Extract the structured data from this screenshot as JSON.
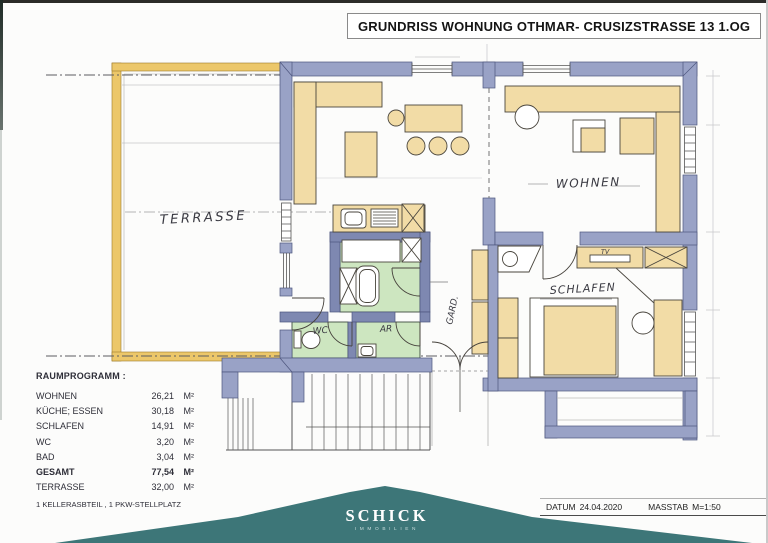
{
  "title": "GRUNDRISS WOHNUNG OTHMAR- CRUSIZSTRASSE 13  1.OG",
  "rooms": {
    "terrasse": "TERRASSE",
    "wohnen": "WOHNEN",
    "schlafen": "SCHLAFEN",
    "wc": "WC",
    "ar": "AR",
    "gard": "GARD.",
    "tv_label": "TV"
  },
  "raumprogramm": {
    "heading": "RAUMPROGRAMM :",
    "rows": [
      {
        "label": "WOHNEN",
        "value": "26,21",
        "unit": "M²"
      },
      {
        "label": "KÜCHE; ESSEN",
        "value": "30,18",
        "unit": "M²"
      },
      {
        "label": "SCHLAFEN",
        "value": "14,91",
        "unit": "M²"
      },
      {
        "label": "WC",
        "value": "3,20",
        "unit": "M²"
      },
      {
        "label": "BAD",
        "value": "3,04",
        "unit": "M²"
      },
      {
        "label": "GESAMT",
        "value": "77,54",
        "unit": "M²"
      },
      {
        "label": "TERRASSE",
        "value": "32,00",
        "unit": "M²"
      }
    ],
    "note": "1 KELLERASBTEIL , 1 PKW-STELLPLATZ"
  },
  "footer": {
    "brand": "SCHICK",
    "brand_sub": "IMMOBILIEN",
    "datum_label": "DATUM",
    "datum_value": "24.04.2020",
    "masstab_label": "MASSTAB",
    "masstab_value": "M=1:50"
  },
  "colors": {
    "wall_blue": "#99a2c6",
    "wall_blue_dark": "#7e88b1",
    "furniture_beige": "#f2dca6",
    "wet_room_green": "#cde6c0",
    "terrace_yellow": "#ecc76a",
    "banner_teal": "#3d7678",
    "ink": "#3a3a42"
  }
}
